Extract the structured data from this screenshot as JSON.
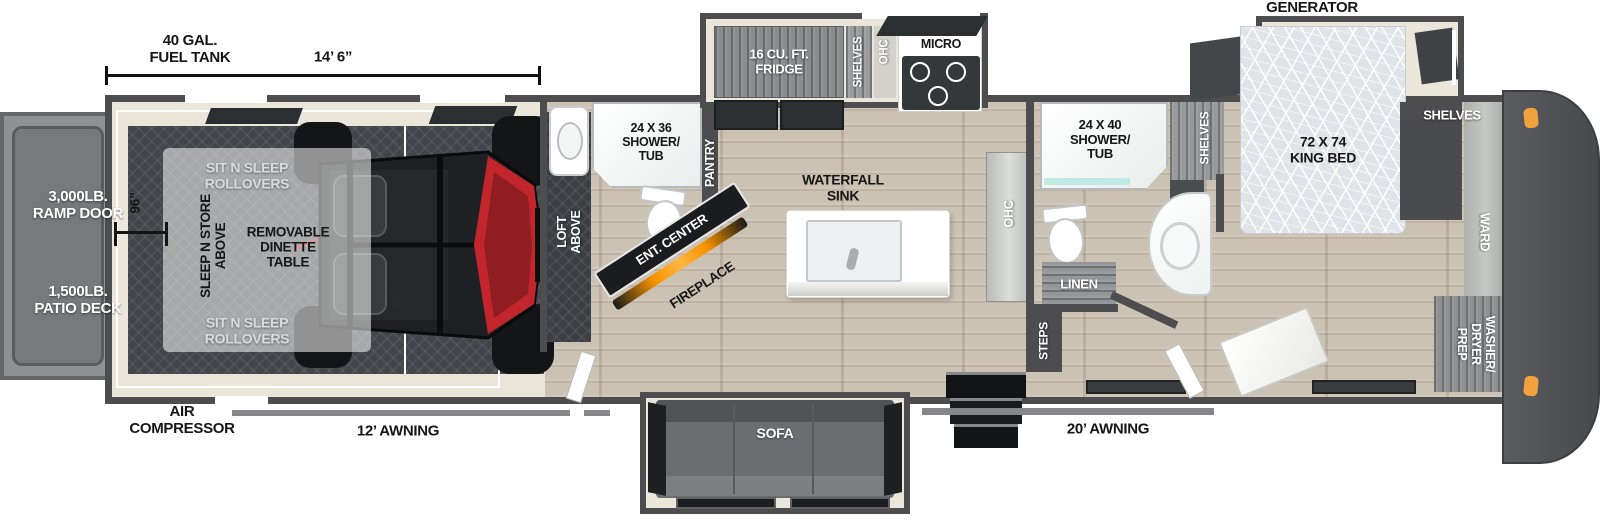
{
  "title": "Toy hauler fifth wheel floorplan",
  "colors": {
    "wall": "#4d4d4f",
    "slide_floor": "#eae6da",
    "utv_red": "#c2262c",
    "fireplace_orange": "#f59300",
    "marker_light_orange": "#f2a23c"
  },
  "exterior": {
    "fuel_tank": "40 GAL.\nFUEL TANK",
    "garage_length": "14’ 6”",
    "generator_prep": "GENERATOR\nPREP",
    "ramp_door": "3,000LB.\nRAMP DOOR",
    "patio_deck": "1,500LB.\nPATIO DECK",
    "air_compressor": "AIR\nCOMPRESSOR",
    "awning_rear": "12’ AWNING",
    "awning_main": "20’ AWNING"
  },
  "garage": {
    "sit_n_sleep_top": "SIT N SLEEP\nROLLOVERS",
    "sit_n_sleep_bottom": "SIT N SLEEP\nROLLOVERS",
    "sleep_n_store": "SLEEP N STORE\nABOVE",
    "dinette": "REMOVABLE\nDINETTE\nTABLE",
    "width_dim": "96”",
    "door_dim": "86”",
    "loft": "LOFT\nABOVE"
  },
  "bath_half": {
    "shower": "24 X 36\nSHOWER/\nTUB"
  },
  "kitchen": {
    "pantry": "PANTRY",
    "ent_center": "ENT. CENTER",
    "fireplace": "FIREPLACE",
    "fridge": "16 CU. FT.\nFRIDGE",
    "shelves": "SHELVES",
    "ohc": "OHC",
    "micro": "MICRO",
    "island_sink": "WATERFALL\nSINK",
    "ohc_counter": "OHC"
  },
  "bath_main": {
    "shower": "24 X 40\nSHOWER/\nTUB",
    "shelves": "SHELVES",
    "linen": "LINEN",
    "steps": "STEPS"
  },
  "bedroom": {
    "bed": "72 X 74\nKING BED",
    "shelves_left": "SHELVES",
    "shelves_right": "SHELVES",
    "ward": "WARD",
    "washer_dryer": "WASHER/\nDRYER\nPREP"
  },
  "living": {
    "sofa": "SOFA"
  }
}
